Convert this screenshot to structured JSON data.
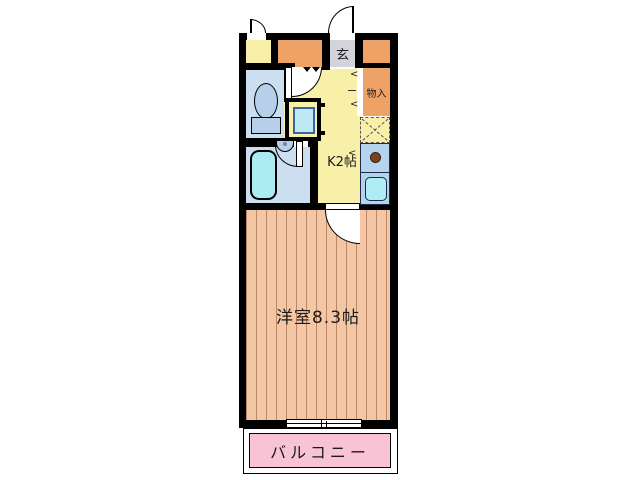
{
  "floorplan": {
    "labels": {
      "entrance": "玄",
      "storage": "物入",
      "kitchen": "K2帖",
      "main_room": "洋室8.3帖",
      "balcony": "バルコニー"
    },
    "icons": {
      "door_swing_chevron": "<"
    },
    "colors": {
      "wall": "#000000",
      "kitchen_floor": "#f8efa9",
      "closet_orange": "#efa265",
      "entrance_gray": "#d3d3db",
      "wet_floor": "#ccdff0",
      "fixture_blue": "#b7cfe9",
      "tub_cyan": "#abebf2",
      "machine_cyan": "#bde8f4",
      "machine_border": "#3565a8",
      "counter_blue": "#b5d3ec",
      "counter_border": "#1b2a4a",
      "sink_cyan": "#adedf3",
      "burner_brown": "#7b431f",
      "room_floor": "#f3c7a4",
      "room_stripe": "#bd8668",
      "balcony_pink": "#f8c3d5"
    }
  }
}
